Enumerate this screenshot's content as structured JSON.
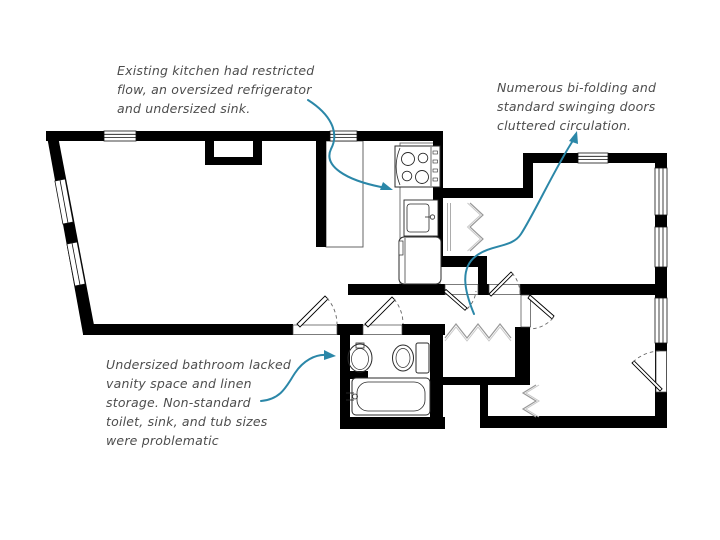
{
  "page": {
    "background": "#ffffff",
    "type": "floor-plan-critique-slide"
  },
  "palette": {
    "wall": "#000000",
    "arrow": "#2b87a8",
    "annotation_text": "#4d4d4d",
    "fixture_line": "#2a2a2a",
    "bifold_line": "#9a9a9a",
    "door_arc": "#666666"
  },
  "annotations": {
    "kitchen": {
      "lines": [
        "Existing kitchen had restricted",
        "flow, an oversized refrigerator",
        "and undersized sink."
      ]
    },
    "doors": {
      "lines": [
        "Numerous bi-folding and",
        "standard swinging doors",
        "cluttered circulation."
      ]
    },
    "bathroom": {
      "lines": [
        "Undersized bathroom lacked",
        "vanity space and linen",
        "storage. Non-standard",
        "toilet, sink, and tub sizes",
        "were problematic"
      ]
    }
  },
  "floorplan": {
    "fixtures": [
      "stove",
      "kitchen-sink",
      "refrigerator",
      "kitchen-counter",
      "bathroom-sink",
      "toilet",
      "bathtub"
    ],
    "door_types": [
      "swing-door",
      "bi-fold-door"
    ],
    "window_count": 8,
    "arrow_count": 3
  }
}
